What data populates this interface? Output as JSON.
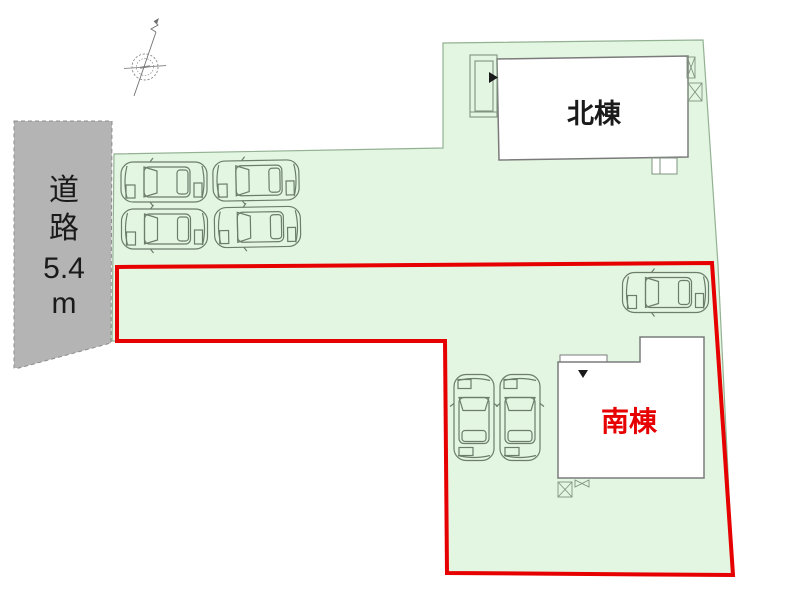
{
  "plan": {
    "colors": {
      "site_fill": "#e3f6e1",
      "site_outline": "#93b193",
      "road_fill": "#b4b4b4",
      "road_outline": "#8d8d8d",
      "boundary_red": "#e60000",
      "building_fill": "#ffffff",
      "building_outline": "#7b7b7b",
      "label_black": "#1a1a1a",
      "line_art": "#6b7d6b"
    },
    "road": {
      "lines": [
        "道",
        "路",
        "5.4",
        "m"
      ]
    },
    "buildings": {
      "north": {
        "label": "北棟"
      },
      "south": {
        "label": "南棟"
      }
    },
    "icons": {
      "compass": "compass-north-arrow",
      "car": "car-top-view",
      "entrance_north": "entrance-triangle-right",
      "entrance_south": "entrance-triangle-down",
      "hatch_box": "crossed-equipment-box",
      "bowtie": "meter-bowtie-mark"
    }
  }
}
